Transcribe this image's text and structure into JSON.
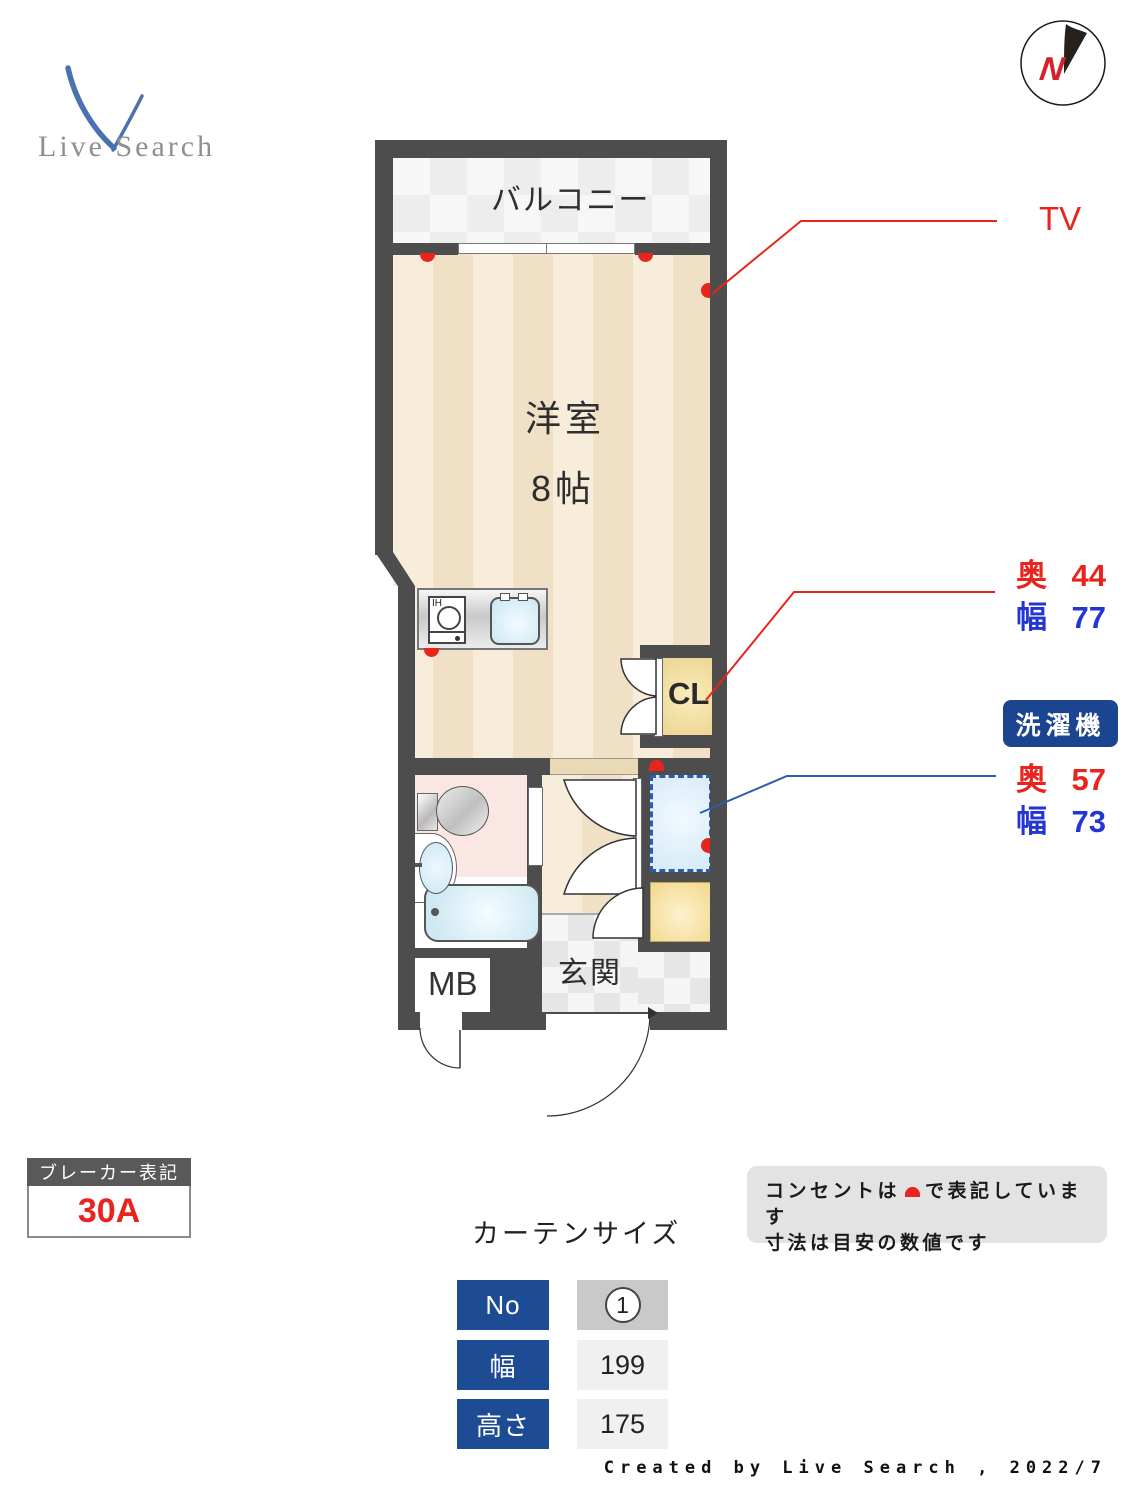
{
  "logo": {
    "text": "Live Search"
  },
  "compass": {
    "letter": "N"
  },
  "plan": {
    "balcony_label": "バルコニー",
    "room_name": "洋室",
    "room_size": "8帖",
    "closet_label": "CL",
    "meter_box_label": "MB",
    "entrance_label": "玄関",
    "kitchen_ih_label": "IH"
  },
  "annotations": {
    "tv_label": "TV",
    "closet_dims": {
      "depth_label": "奥",
      "depth_value": "44",
      "width_label": "幅",
      "width_value": "77"
    },
    "washer_badge": "洗濯機",
    "washer_dims": {
      "depth_label": "奥",
      "depth_value": "57",
      "width_label": "幅",
      "width_value": "73"
    }
  },
  "breaker": {
    "title": "ブレーカー表記",
    "value": "30A"
  },
  "curtain": {
    "title": "カーテンサイズ",
    "rows": [
      {
        "label": "No",
        "value": "1"
      },
      {
        "label": "幅",
        "value": "199"
      },
      {
        "label": "高さ",
        "value": "175"
      }
    ]
  },
  "note": {
    "line1_pre": "コンセントは",
    "line1_post": "で表記しています",
    "line2": "寸法は目安の数値です"
  },
  "credit": "Created by Live Search , 2022/7",
  "colors": {
    "wall": "#4d4d4d",
    "floor_light": "#f8eddb",
    "floor_dark": "#f0e0c5",
    "annotation_red": "#e8251d",
    "annotation_blue": "#2336d4",
    "line_blue": "#2b5cad",
    "badge_blue": "#1b4590",
    "table_label_blue": "#1e4c94",
    "closet_fill": "#f0d994",
    "washer_fill": "#ddeefa",
    "bathroom_pink": "#fae6e2",
    "tub_blue": "#cfe9f2"
  }
}
